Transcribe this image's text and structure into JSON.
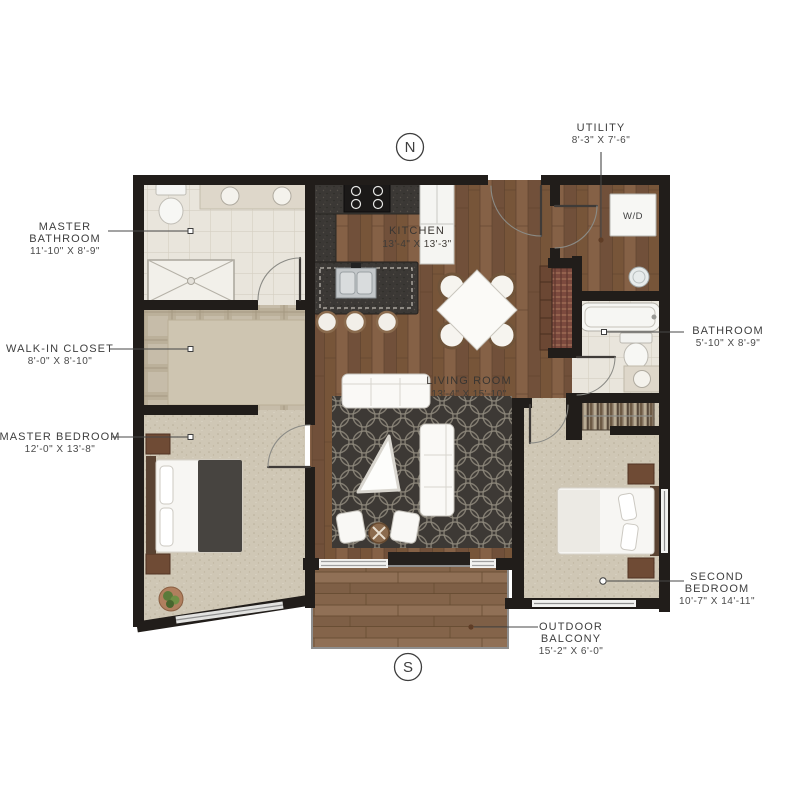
{
  "plan": {
    "compass": {
      "north": "N",
      "south": "S"
    },
    "labels": {
      "master_bathroom": {
        "line1": "MASTER",
        "line2": "BATHROOM",
        "dims": "11'-10\" X 8'-9\""
      },
      "walk_in_closet": {
        "line1": "WALK-IN CLOSET",
        "dims": "8'-0\" X 8'-10\""
      },
      "master_bedroom": {
        "line1": "MASTER BEDROOM",
        "dims": "12'-0\" X 13'-8\""
      },
      "kitchen": {
        "line1": "KITCHEN",
        "dims": "13'-4\" X 13'-3\""
      },
      "living_room": {
        "line1": "LIVING ROOM",
        "dims": "13'-4\" X 15'-10\""
      },
      "utility": {
        "line1": "UTILITY",
        "dims": "8'-3\" X 7'-6\""
      },
      "bathroom": {
        "line1": "BATHROOM",
        "dims": "5'-10\" X 8'-9\""
      },
      "second_bedroom": {
        "line1": "SECOND",
        "line2": "BEDROOM",
        "dims": "10'-7\" X 14'-11\""
      },
      "outdoor_balcony": {
        "line1": "OUTDOOR",
        "line2": "BALCONY",
        "dims": "15'-2\" X 6'-0\""
      }
    },
    "appliances": {
      "washer_dryer": "W/D"
    },
    "colors": {
      "wall": "#211d1a",
      "wood_floor": "#7d5a40",
      "deck": "#8a6a4f",
      "carpet": "#cfc7b5",
      "tile": "#e9e5dc",
      "counter": "#3b3835",
      "rug": "#3d3935",
      "accent_wood": "#6f4b35",
      "label_text": "#3e3e3e"
    }
  }
}
